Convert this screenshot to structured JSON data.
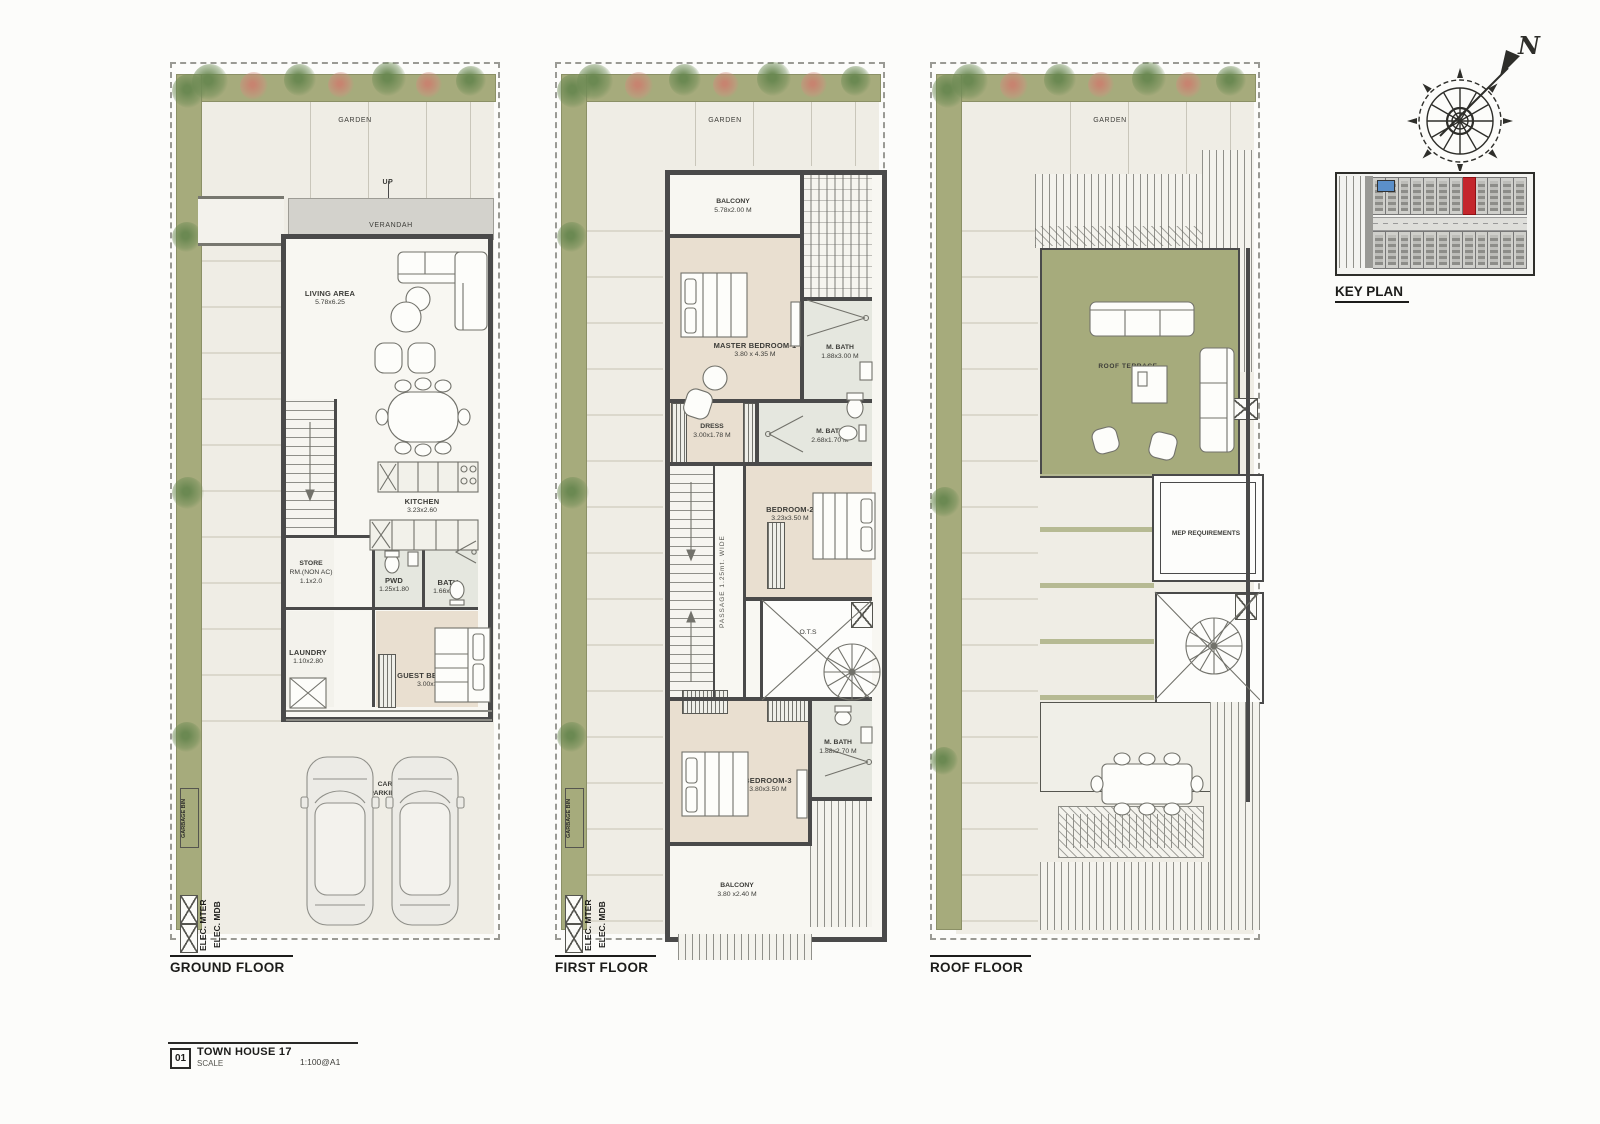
{
  "sheet": {
    "title_block": {
      "number": "01",
      "title": "TOWN HOUSE 17",
      "scale_label": "SCALE",
      "scale_value": "1:100@A1"
    }
  },
  "key_plan": {
    "label": "KEY PLAN",
    "highlight_index": 7,
    "rows": 2,
    "units_per_row": 12
  },
  "compass": {
    "north": "N"
  },
  "colors": {
    "terrace_green": "#a6ab7c",
    "garden_green": "#a9ad80",
    "highlight_red": "#c4262c",
    "wall_gray": "#4a4a4a",
    "room_beige": "#e9dfd0"
  },
  "floors": {
    "ground": {
      "label": "GROUND FLOOR",
      "garden": "GARDEN",
      "up": "UP",
      "verandah": "VERANDAH",
      "living": {
        "name": "LIVING AREA",
        "dim": "5.78x6.25"
      },
      "dining": {
        "name": "DINING"
      },
      "kitchen": {
        "name": "KITCHEN",
        "dim": "3.23x2.60"
      },
      "store": {
        "name": "STORE",
        "name2": "RM.(NON AC)",
        "dim": "1.1x2.0"
      },
      "pwd": {
        "name": "PWD",
        "dim": "1.25x1.80"
      },
      "bath": {
        "name": "BATH",
        "dim": "1.66x1.80"
      },
      "laundry": {
        "name": "LAUNDRY",
        "dim": "1.10x2.80"
      },
      "guest": {
        "name": "GUEST BEDROOM",
        "dim": "3.00x3.00"
      },
      "parking": {
        "name": "CAR",
        "name2": "PARKING"
      },
      "garbage": "GARBAGE BIN",
      "elec_meter": "ELEC. MTER",
      "elec_mdb": "ELEC. MDB"
    },
    "first": {
      "label": "FIRST FLOOR",
      "garden": "GARDEN",
      "balcony_top": {
        "name": "BALCONY",
        "dim": "5.78x2.00 M"
      },
      "master": {
        "name": "MASTER BEDROOM-1",
        "dim": "3.80 x 4.35 M"
      },
      "mbath1": {
        "name": "M. BATH",
        "dim": "1.88x3.00 M"
      },
      "dress": {
        "name": "DRESS",
        "dim": "3.00x1.78 M"
      },
      "mbath2": {
        "name": "M. BATH",
        "dim": "2.68x1.70 M"
      },
      "bedroom2": {
        "name": "BEDROOM-2",
        "dim": "3.23x3.50 M"
      },
      "passage": "PASSAGE 1.25mt. WIDE",
      "ots": "O.T.S",
      "bedroom3": {
        "name": "BEDROOM-3",
        "dim": "3.80x3.50 M"
      },
      "mbath3": {
        "name": "M. BATH",
        "dim": "1.88x2.70 M"
      },
      "balcony_bottom": {
        "name": "BALCONY",
        "dim": "3.80 x2.40 M"
      },
      "garbage": "GARBAGE BIN",
      "elec_meter": "ELEC. MTER",
      "elec_mdb": "ELEC. MDB"
    },
    "roof": {
      "label": "ROOF FLOOR",
      "garden": "GARDEN",
      "terrace_top": "ROOF TERRACE",
      "mep": "MEP REQUIREMENTS",
      "terrace_bottom": "ROOF TERRACE"
    }
  }
}
